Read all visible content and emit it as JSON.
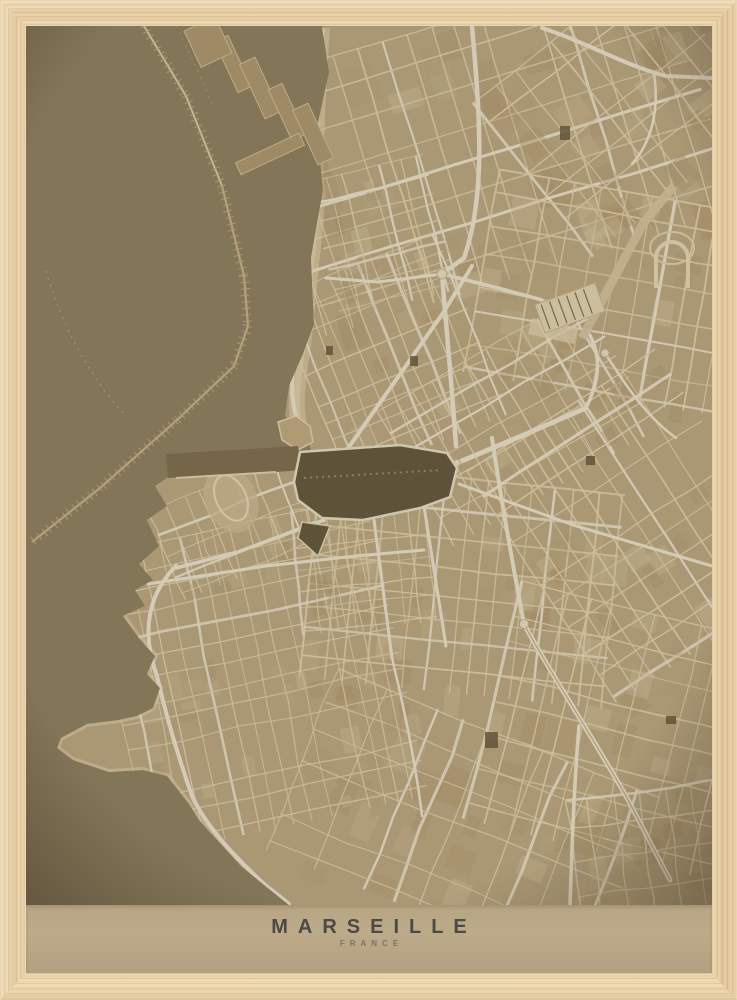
{
  "artwork": {
    "title": "MARSEILLE",
    "subtitle": "FRANCE"
  },
  "palette": {
    "frame_wood": "#e8d1a9",
    "sea": "#685939",
    "harbor_water": "#463a1f",
    "land": "#c3a87a",
    "street_minor": "#ead9b2",
    "street_major": "#f7f0dd",
    "quay": "#d8c69a",
    "pier": "#a68e61",
    "breakwater": "#c7b183",
    "block_shade": "#a88c5e",
    "band": "#b6a483",
    "title_color": "#4b4a44",
    "subtitle_color": "#7e7361"
  }
}
